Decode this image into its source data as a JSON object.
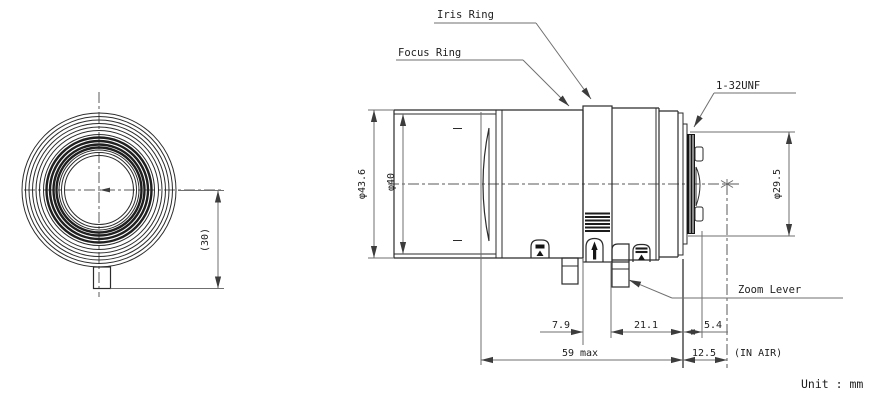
{
  "drawing": {
    "unit_note": "Unit : mm",
    "labels": {
      "iris_ring": "Iris Ring",
      "focus_ring": "Focus Ring",
      "mount_thread": "1-32UNF",
      "zoom_lever": "Zoom Lever"
    },
    "front_view": {
      "lever_offset": "(30)"
    },
    "side_view": {
      "outer_diameter": "φ43.6",
      "front_group_diameter": "φ40",
      "mount_image_diameter": "φ29.5",
      "iris_ring_width": "7.9",
      "rear_barrel_length": "21.1",
      "rear_protrusion": "5.4",
      "overall_length": "59 max",
      "back_focal_distance": "12.5",
      "back_focal_note": "(IN AIR)"
    }
  }
}
